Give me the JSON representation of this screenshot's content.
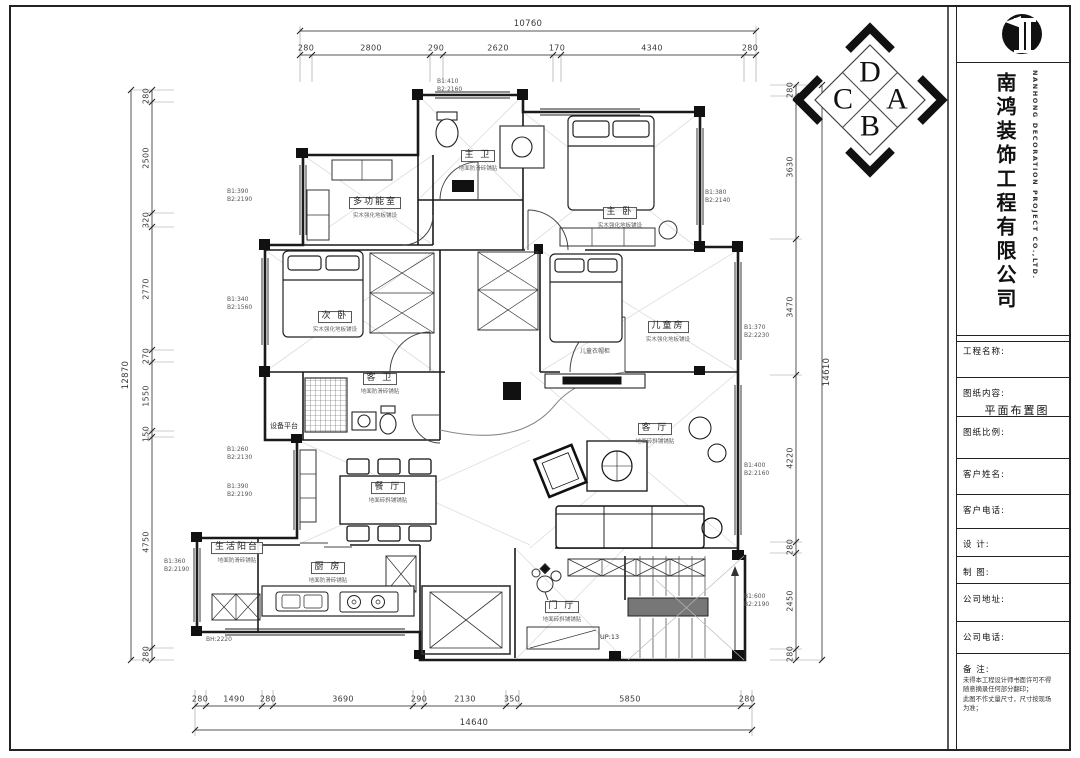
{
  "titleblock": {
    "company_cn": "南鸿装饰工程有限公司",
    "company_en": "NANHONG DECORATION PROJECT CO.,LTD.",
    "fields": [
      {
        "label": "工程名称:",
        "value": ""
      },
      {
        "label": "图纸内容:",
        "value": "平面布置图"
      },
      {
        "label": "图纸比例:",
        "value": ""
      },
      {
        "label": "客户姓名:",
        "value": ""
      },
      {
        "label": "客户电话:",
        "value": ""
      },
      {
        "label": "设  计:",
        "value": ""
      },
      {
        "label": "制  图:",
        "value": ""
      },
      {
        "label": "公司地址:",
        "value": ""
      },
      {
        "label": "公司电话:",
        "value": ""
      }
    ],
    "remark_label": "备  注:",
    "remark_line1": "未得本工程设计师书面许可不得",
    "remark_line2": "随意摘录任何部分翻印；",
    "remark_line3": "此图不作丈量尺寸，尺寸按现场",
    "remark_line4": "为准；"
  },
  "compass": {
    "top": "D",
    "left": "C",
    "right": "A",
    "bottom": "B"
  },
  "rooms": [
    {
      "name": "主 卫",
      "finish": "地面防滑砖铺贴"
    },
    {
      "name": "多功能室",
      "finish": "实木强化地板铺设"
    },
    {
      "name": "主 卧",
      "finish": "实木强化地板铺设"
    },
    {
      "name": "次 卧",
      "finish": "实木强化地板铺设"
    },
    {
      "name": "儿童房",
      "finish": "实木强化地板铺设"
    },
    {
      "name": "客 卫",
      "finish": "地面防滑砖铺贴"
    },
    {
      "name": "餐 厅",
      "finish": "地面砖斜铺铺贴"
    },
    {
      "name": "客 厅",
      "finish": "地面砖斜铺铺贴"
    },
    {
      "name": "厨 房",
      "finish": "地面防滑砖铺贴"
    },
    {
      "name": "生活阳台",
      "finish": "地面防滑砖铺贴"
    },
    {
      "name": "门 厅",
      "finish": "地面砖斜铺铺贴"
    },
    {
      "name": "设备平台",
      "finish": ""
    }
  ],
  "window_tags": [
    {
      "l1": "B1:410",
      "l2": "B2:2160"
    },
    {
      "l1": "B1:390",
      "l2": "B2:2190"
    },
    {
      "l1": "B1:340",
      "l2": "B2:1560"
    },
    {
      "l1": "B1:380",
      "l2": "B2:2140"
    },
    {
      "l1": "B1:370",
      "l2": "B2:2230"
    },
    {
      "l1": "B1:260",
      "l2": "B2:2130"
    },
    {
      "l1": "B1:390",
      "l2": "B2:2190"
    },
    {
      "l1": "B1:360",
      "l2": "B2:2190"
    },
    {
      "l1": "B1:400",
      "l2": "B2:2160"
    },
    {
      "l1": "B1:600",
      "l2": "B2:2190"
    },
    {
      "l1": "BH:2220",
      "l2": ""
    }
  ],
  "annotations": {
    "stairs": "UP:13",
    "kids_closet": "儿童衣帽柜"
  },
  "dims": {
    "top": {
      "total": "10760",
      "segs": [
        "280",
        "2800",
        "290",
        "2620",
        "170",
        "4340",
        "280"
      ]
    },
    "bottom": {
      "total": "14640",
      "segs": [
        "280",
        "1490",
        "280",
        "3690",
        "290",
        "2130",
        "350",
        "5850",
        "280"
      ]
    },
    "left": {
      "total": "12870",
      "segs": [
        "280",
        "2500",
        "320",
        "2770",
        "270",
        "1550",
        "150",
        "4750",
        "280"
      ]
    },
    "right": {
      "total": "14610",
      "segs": [
        "280",
        "3630",
        "3470",
        "4220",
        "280",
        "2450",
        "280"
      ]
    }
  }
}
